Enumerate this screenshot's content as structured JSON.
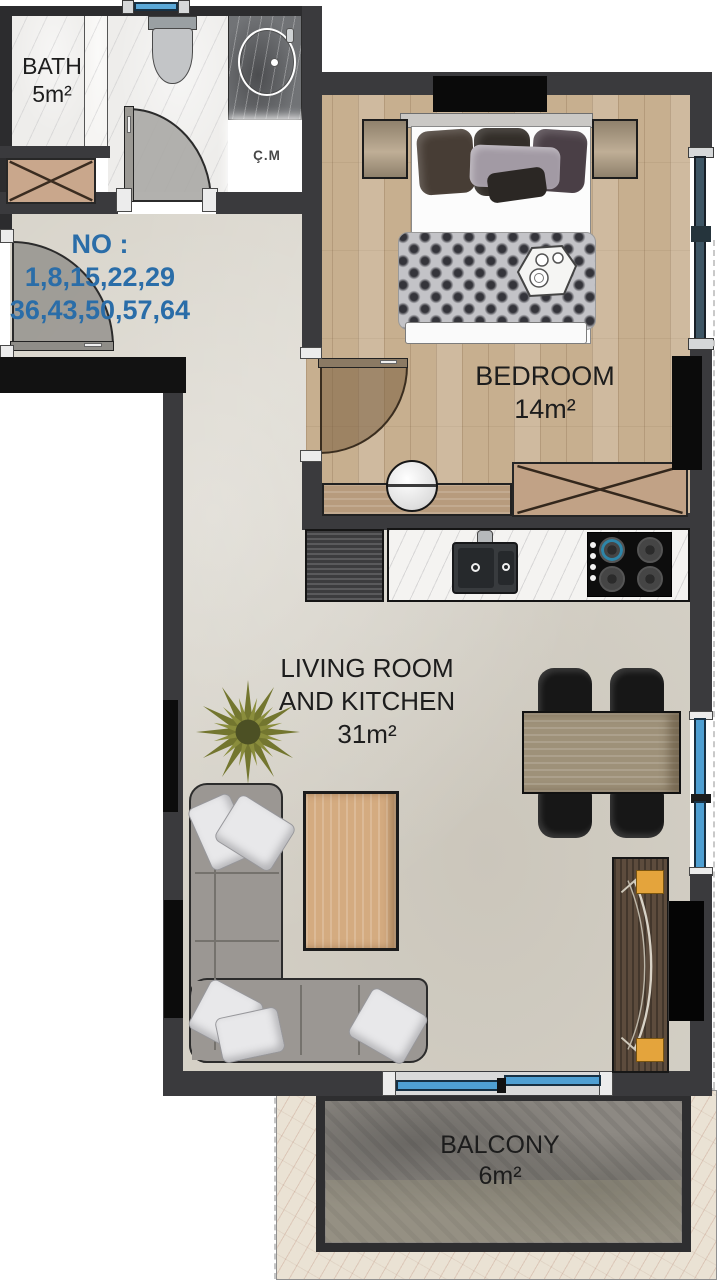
{
  "page": {
    "type": "apartment-floor-plan"
  },
  "unit_numbers": {
    "label": "NO :",
    "row1": "1,8,15,22,29",
    "row2": "36,43,50,57,64"
  },
  "rooms": {
    "bath": {
      "name": "BATH",
      "area": "5m²"
    },
    "shaft": {
      "name": "Ç.M"
    },
    "bedroom": {
      "name": "BEDROOM",
      "area": "14m²"
    },
    "living": {
      "name_line1": "LIVING ROOM",
      "name_line2": "AND KITCHEN",
      "area": "31m²"
    },
    "balcony": {
      "name": "BALCONY",
      "area": "6m²"
    }
  },
  "colors": {
    "unit_number_text": "#2a6da8",
    "room_label_text": "#1d1d1d",
    "wall": "#3a3a3d",
    "window_glass": "#4f9fd2",
    "bedroom_window_glass": "#3e5665",
    "wood_floor": "#c7af8f",
    "tile_floor": "#d7d3c9",
    "balcony_stone": "#8d8983",
    "balcony_marble": "#eae2d4",
    "console_accent_yellow": "#e4a43c"
  },
  "furniture_icons": [
    "toilet",
    "washbasin",
    "shaft-box",
    "shoe-cabinet-x",
    "entrance-door-swing",
    "bath-door-swing",
    "bedroom-door-swing",
    "double-bed",
    "nightstand",
    "tv",
    "wardrobe-x",
    "desk",
    "stool",
    "fridge",
    "kitchen-sink",
    "cooktop",
    "sofa-l-shape",
    "coffee-table",
    "plant",
    "dining-table",
    "dining-chair",
    "tv-console",
    "window",
    "sliding-balcony-door"
  ]
}
